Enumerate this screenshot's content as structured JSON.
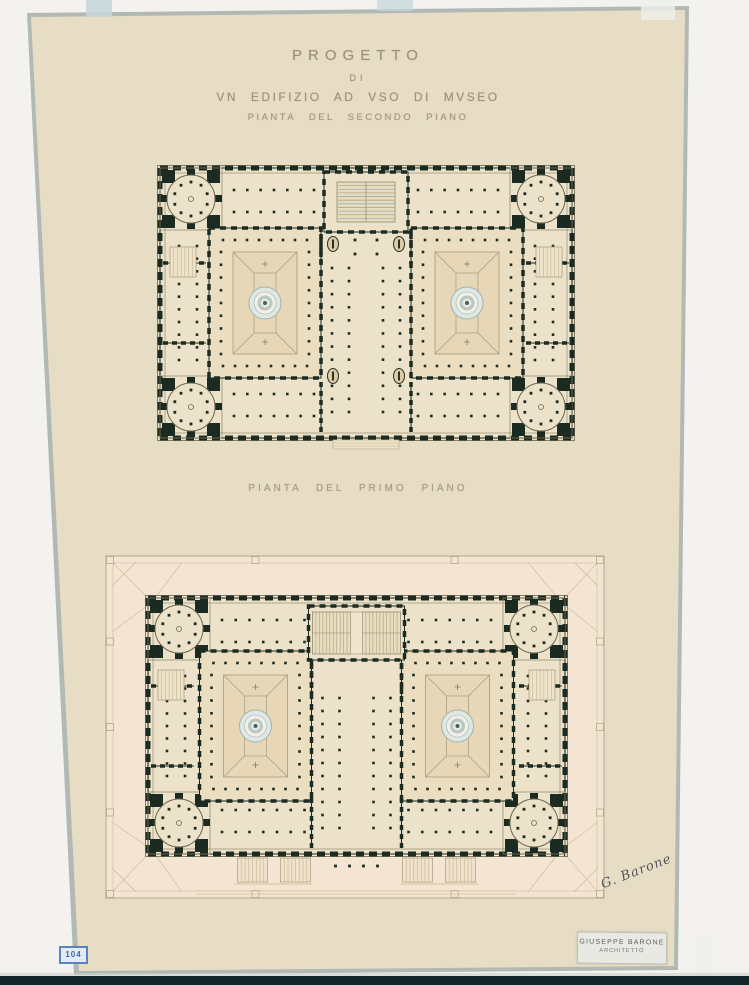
{
  "artwork": {
    "title_line1": "PROGETTO",
    "title_line2": "DI",
    "title_line3": "VN EDIFIZIO AD VSO DI MVSEO",
    "upper_plan_caption": "PIANTA DEL SECONDO PIANO",
    "lower_plan_caption": "PIANTA DEL PRIMO PIANO",
    "signature": "G. Barone",
    "credit_name": "GIUSEPPE BARONE",
    "credit_role": "ARCHITETTO",
    "stamp_number": "104"
  },
  "colors": {
    "scan_bg": "#f3f2ee",
    "scan_bar": "#13252a",
    "sheet": "#e7ddc5",
    "sheet_edge": "#b2b9b5",
    "tape": "#c6d6d8",
    "building_fill": "#ece2ca",
    "site_fill": "#f4e5d2",
    "wall": "#1c2b21",
    "thin_line": "#9b8f75",
    "court_floor": "#eaddc0",
    "court_inner": "#e7d7b6",
    "fountain_ring": "#9eb4b1",
    "fountain_fill": "#dfe7e3",
    "stair_line": "#b3a88b",
    "stair_line2": "#a3adbb",
    "hatch": "#c3b392",
    "title_ink": "#9c9179",
    "stamp_blue": "#4a74b4",
    "signature_ink": "#3a3f45"
  }
}
